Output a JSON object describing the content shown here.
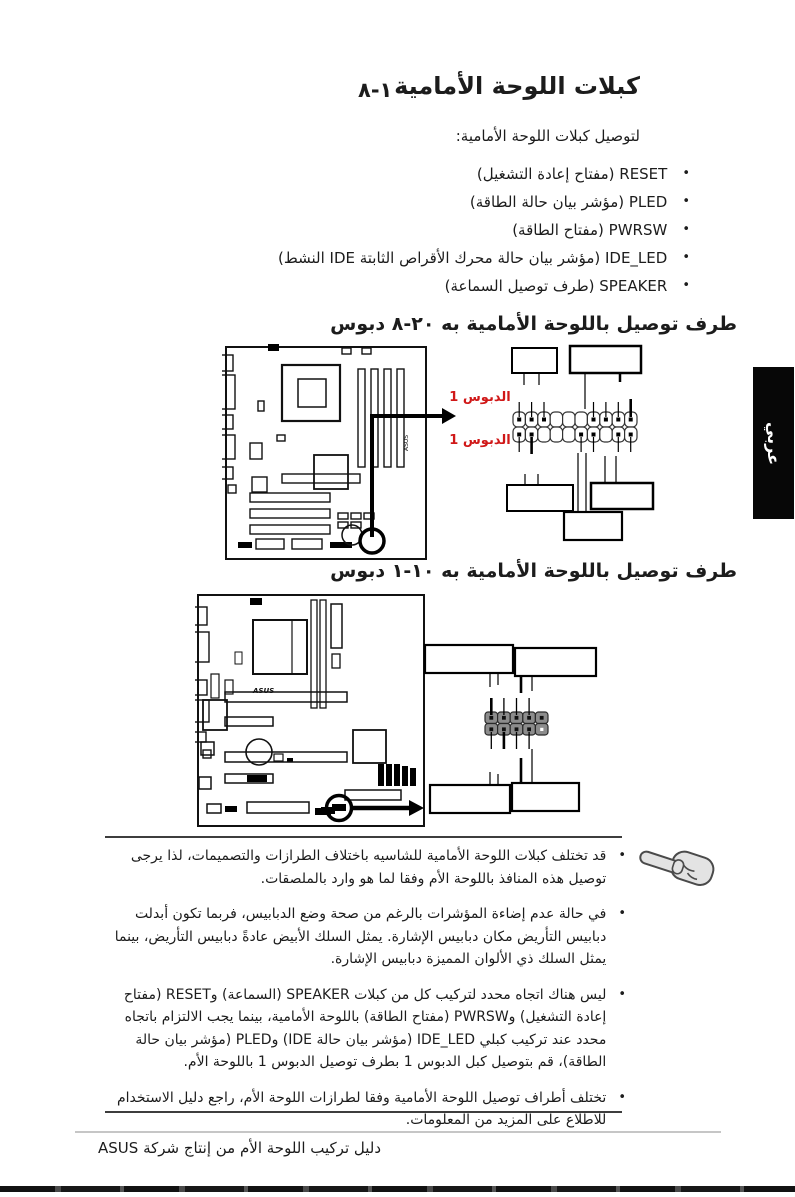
{
  "page": {
    "section_number": "١-٨",
    "title": "كبلات اللوحة الأمامية",
    "intro": "لتوصيل كبلات اللوحة الأمامية:",
    "side_tab": "عربي",
    "footer": "دليل تركيب اللوحة الأم من إنتاج شركة ASUS"
  },
  "cables": [
    "RESET (مفتاح إعادة التشغيل)",
    "PLED (مؤشر بيان حالة الطاقة)",
    "PWRSW (مفتاح الطاقة)",
    "IDE_LED (مؤشر بيان حالة محرك الأقراص الثابتة IDE النشط)",
    "SPEAKER (طرف توصيل السماعة)"
  ],
  "sections": [
    {
      "heading": {
        "pre": "طرف توصيل باللوحة الأمامية به",
        "pins": "٢٠-٨",
        "post": "دبوس"
      },
      "pin1_label": "الدبوس 1"
    },
    {
      "heading": {
        "pre": "طرف توصيل باللوحة الأمامية به",
        "pins": "١٠-١",
        "post": "دبوس"
      }
    }
  ],
  "notes": [
    "قد تختلف كبلات اللوحة الأمامية للشاسيه باختلاف الطرازات والتصميمات، لذا يرجى توصيل هذه المنافذ باللوحة الأم وفقا لما هو وارد بالملصقات.",
    "في حالة عدم إضاءة المؤشرات بالرغم من صحة وضع الدبابيس، فربما تكون أبدلت دبابيس التأريض مكان دبابيس الإشارة. يمثل السلك الأبيض عادةً دبابيس التأريض، بينما يمثل السلك ذي الألوان المميزة دبابيس الإشارة.",
    "ليس هناك اتجاه محدد لتركيب كل من كبلات SPEAKER (السماعة) وRESET (مفتاح إعادة التشغيل) وPWRSW (مفتاح الطاقة) باللوحة الأمامية، بينما يجب الالتزام باتجاه محدد عند تركيب كبلي IDE_LED (مؤشر بيان حالة IDE) وPLED (مؤشر بيان حالة الطاقة)، قم بتوصيل كبل الدبوس 1 بطرف توصيل الدبوس 1 باللوحة الأم.",
    "تختلف أطراف توصيل اللوحة الأمامية وفقا لطرازات اللوحة الأم، راجع دليل الاستخدام للاطلاع على المزيد من المعلومات."
  ],
  "bullet_glyph": "•",
  "colors": {
    "accent_red": "#d01818",
    "tab_bg": "#070707",
    "line_dark": "#3d3d3d"
  }
}
